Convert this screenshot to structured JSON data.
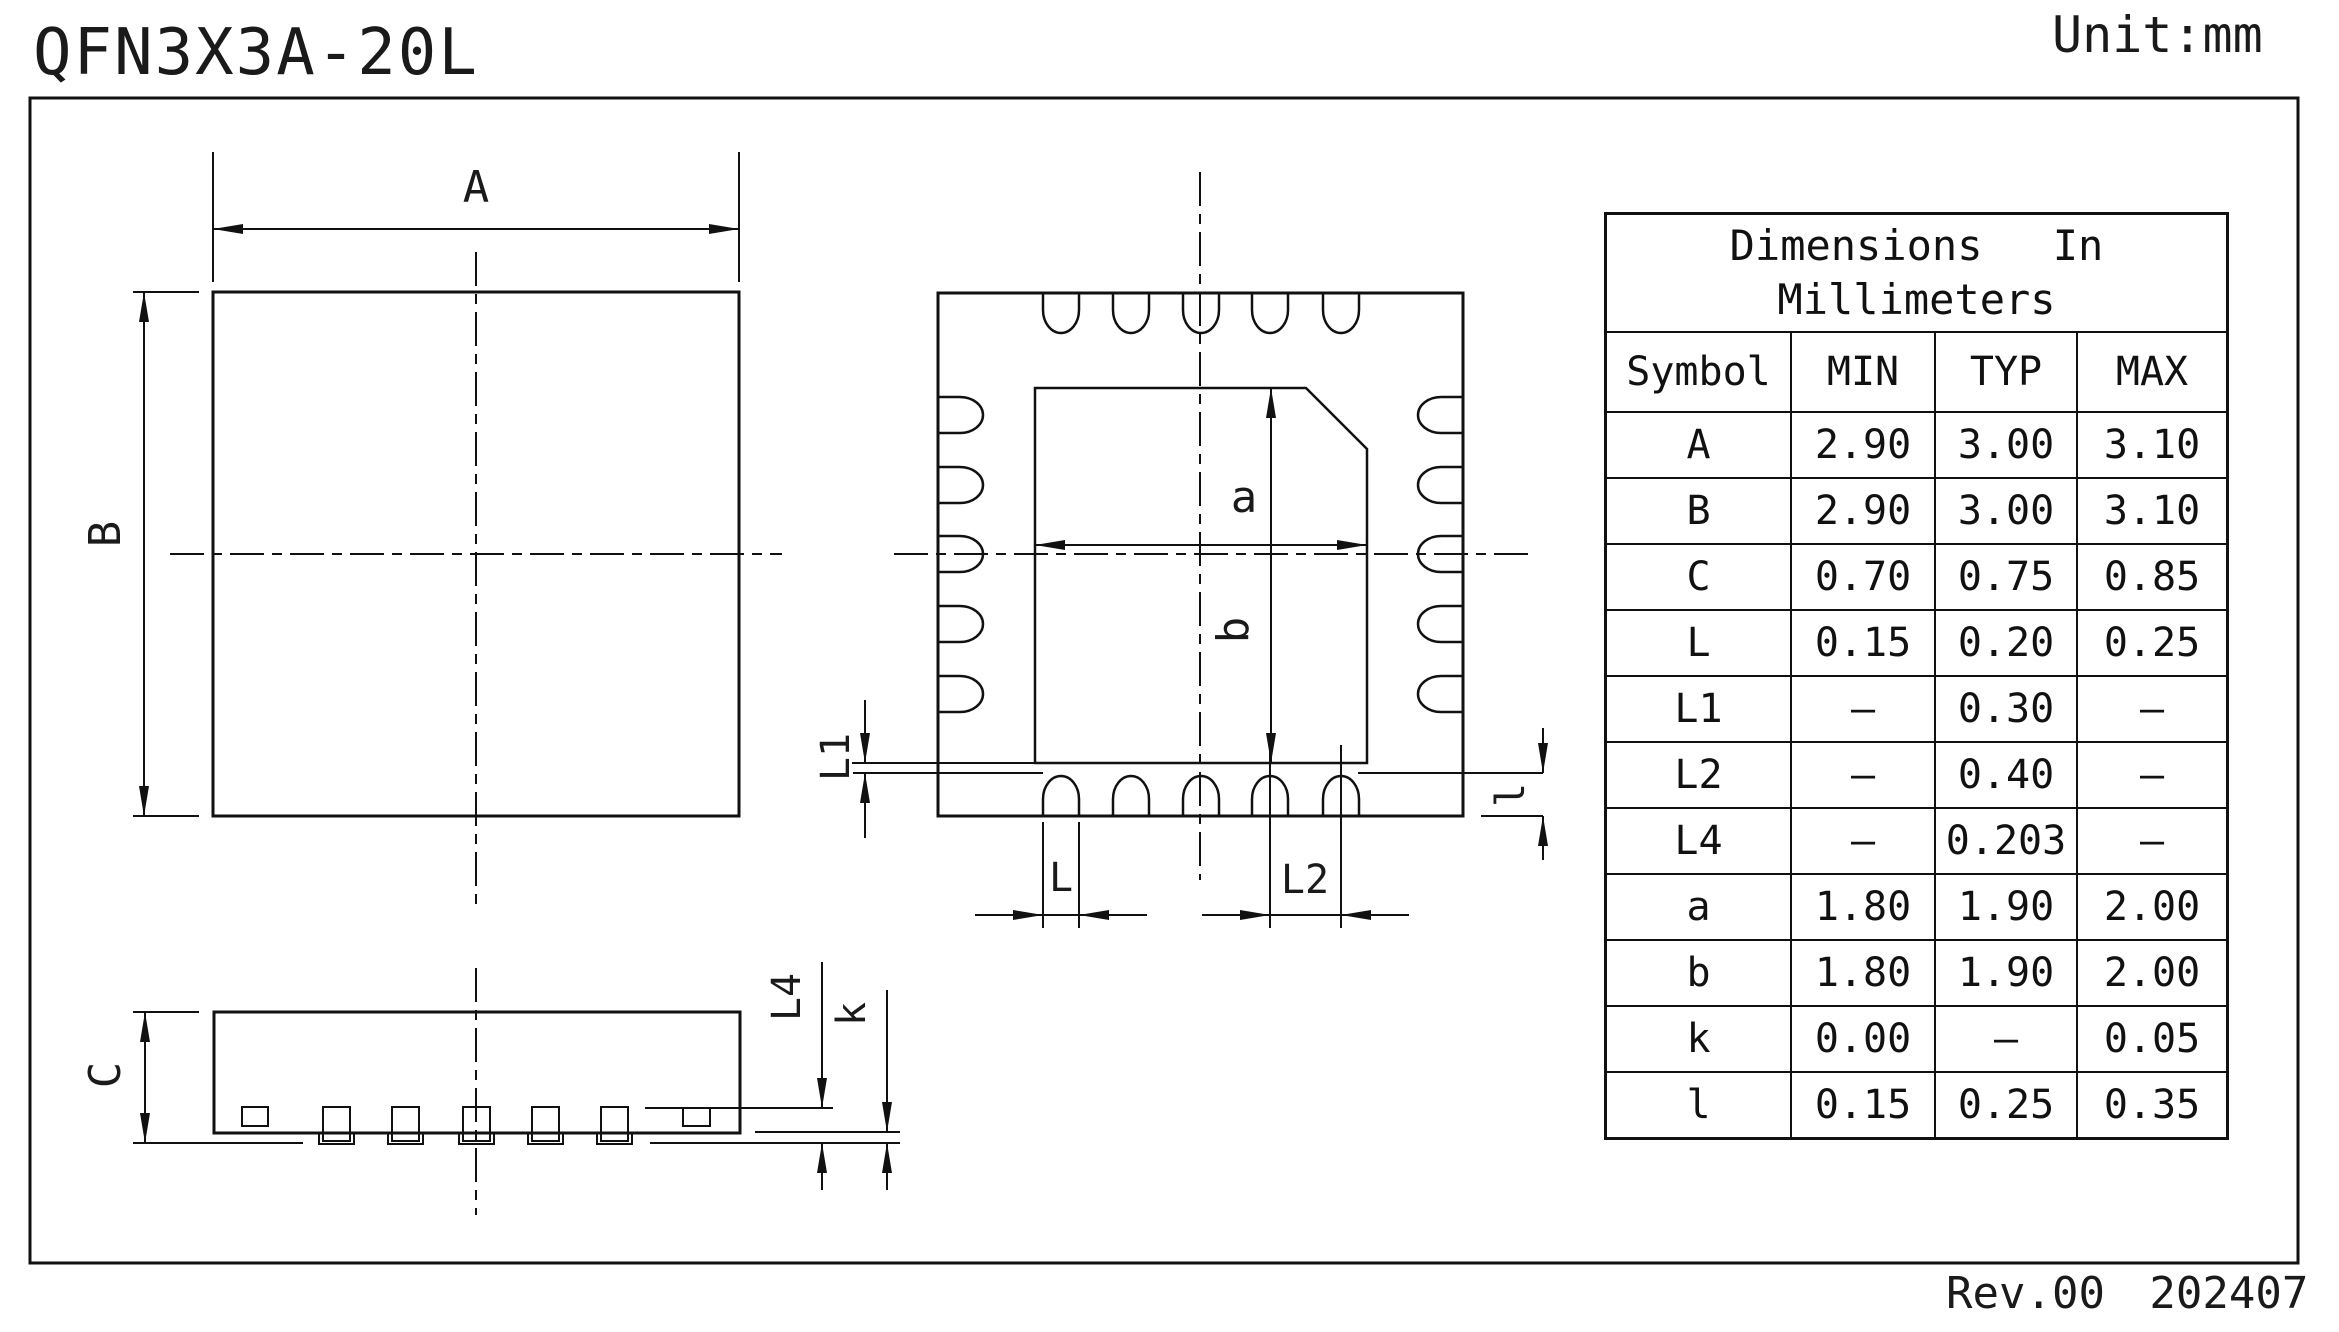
{
  "meta": {
    "title": "QFN3X3A-20L",
    "unit": "Unit:mm",
    "revision": "Rev.00 202407"
  },
  "table": {
    "title_line1": "Dimensions In",
    "title_line2": "Millimeters",
    "headers": {
      "symbol": "Symbol",
      "min": "MIN",
      "typ": "TYP",
      "max": "MAX"
    },
    "rows": [
      {
        "symbol": "A",
        "min": "2.90",
        "typ": "3.00",
        "max": "3.10"
      },
      {
        "symbol": "B",
        "min": "2.90",
        "typ": "3.00",
        "max": "3.10"
      },
      {
        "symbol": "C",
        "min": "0.70",
        "typ": "0.75",
        "max": "0.85"
      },
      {
        "symbol": "L",
        "min": "0.15",
        "typ": "0.20",
        "max": "0.25"
      },
      {
        "symbol": "L1",
        "min": "–",
        "typ": "0.30",
        "max": "–"
      },
      {
        "symbol": "L2",
        "min": "–",
        "typ": "0.40",
        "max": "–"
      },
      {
        "symbol": "L4",
        "min": "–",
        "typ": "0.203",
        "max": "–"
      },
      {
        "symbol": "a",
        "min": "1.80",
        "typ": "1.90",
        "max": "2.00"
      },
      {
        "symbol": "b",
        "min": "1.80",
        "typ": "1.90",
        "max": "2.00"
      },
      {
        "symbol": "k",
        "min": "0.00",
        "typ": "–",
        "max": "0.05"
      },
      {
        "symbol": "l",
        "min": "0.15",
        "typ": "0.25",
        "max": "0.35"
      }
    ]
  },
  "labels": {
    "top_width": "A",
    "top_height": "B",
    "body_height": "C",
    "thermal_width": "a",
    "thermal_height": "b",
    "lead_width": "L",
    "l1": "L1",
    "pitch": "L2",
    "lead_thickness": "L4",
    "standoff": "k",
    "lead_length": "l"
  }
}
